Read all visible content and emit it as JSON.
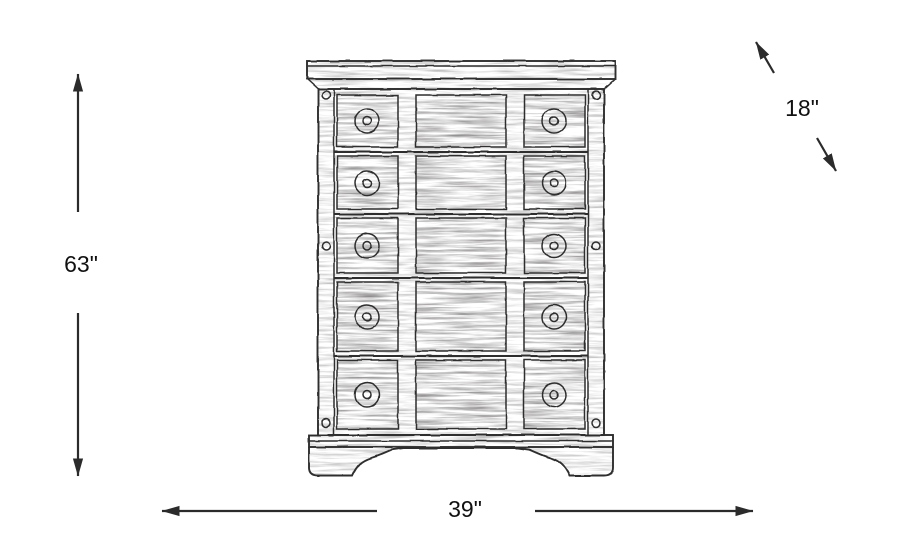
{
  "diagram": {
    "illustration_alt": "Black-and-white pencil-sketch drawing of a tall chest with five drawer rows, round knobs on left and right drawers, crown molding top and bracket feet",
    "dimensions": {
      "height": {
        "name": "height",
        "value": "63\"",
        "orientation": "vertical"
      },
      "width": {
        "name": "width",
        "value": "39\"",
        "orientation": "horizontal"
      },
      "depth": {
        "name": "depth",
        "value": "18\"",
        "orientation": "diagonal"
      }
    },
    "colors": {
      "background": "#ffffff",
      "line": "#2b2b2b",
      "label_text": "#111111"
    }
  }
}
